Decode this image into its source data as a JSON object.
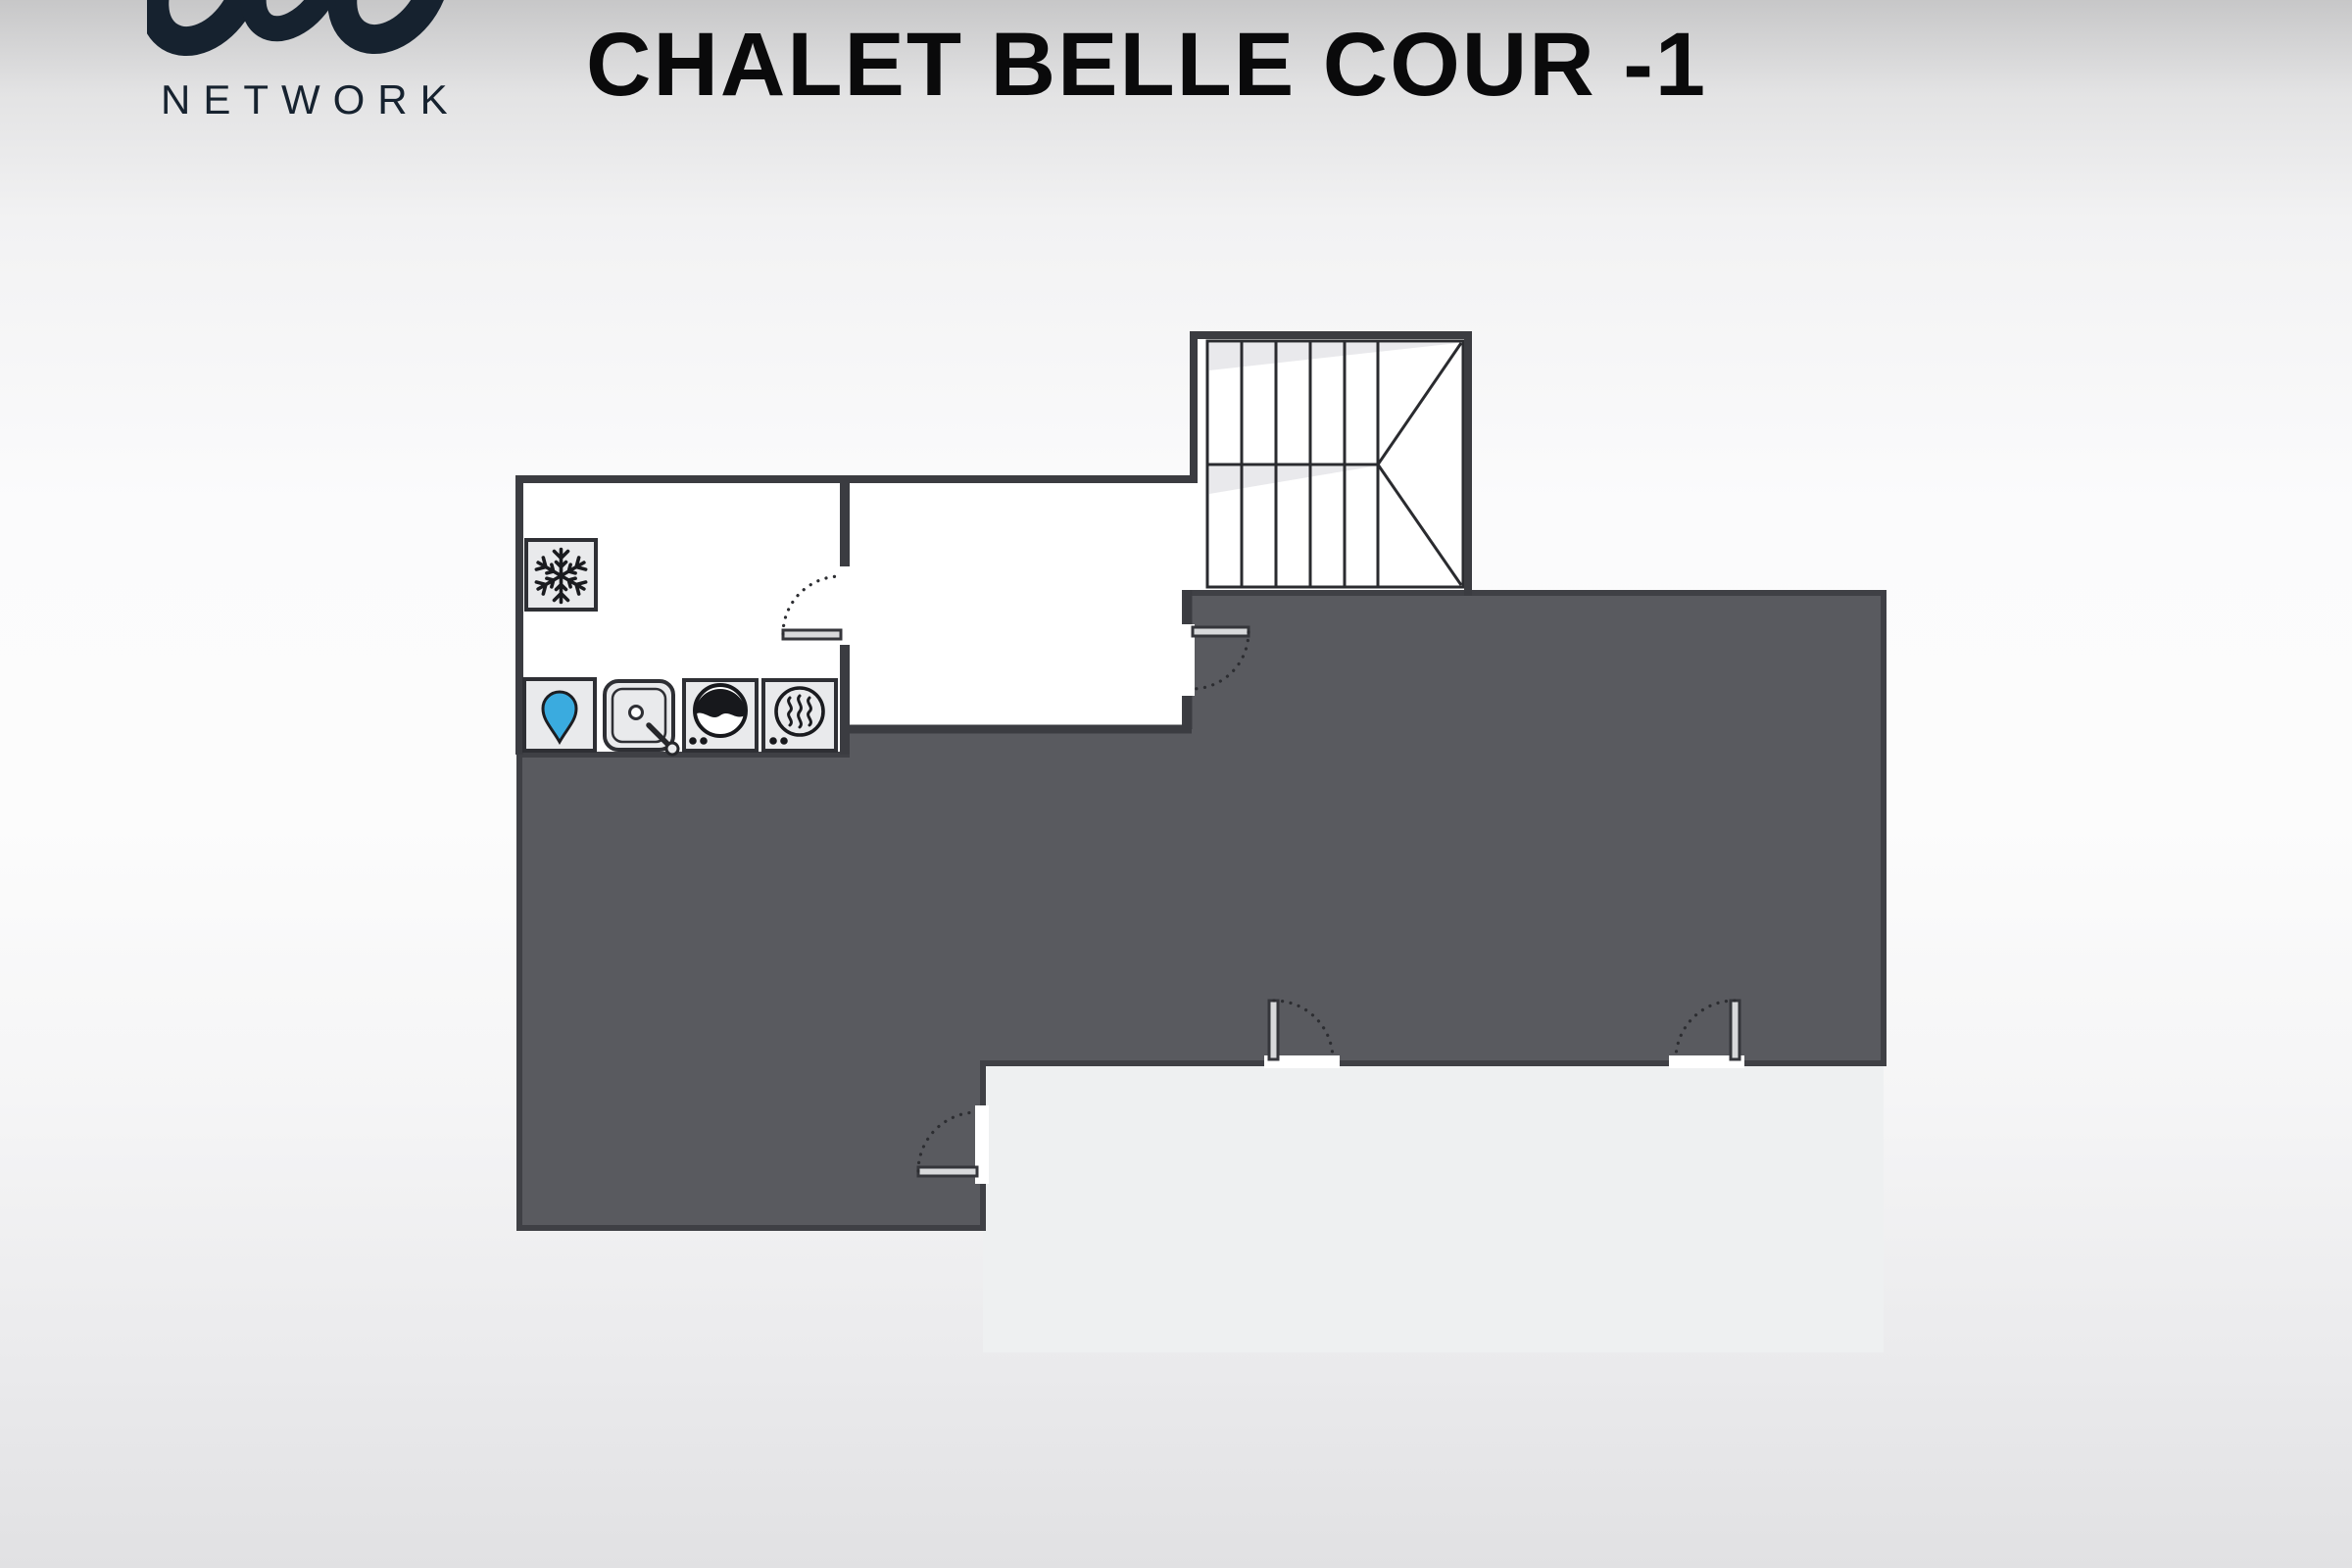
{
  "header": {
    "logo_text": "NETWORK",
    "title": "CHALET BELLE COUR -1"
  },
  "floorplan": {
    "level": "-1",
    "colors": {
      "wall": "#3b3c41",
      "dark_area_fill": "#595a5f",
      "dark_area_border": "#3f4045",
      "room_fill": "#ffffff",
      "lower_area_fill": "#eef0f1",
      "stair_shade": "#e9e9ec",
      "icon_square_fill": "#e9eaec",
      "icon_stroke": "#1a1b1f",
      "water_drop_blue": "#3aabdf",
      "door_leaf_fill": "#d8d9db",
      "logo_navy": "#16222f",
      "title_black": "#0a0a0b"
    },
    "equipment_icons": [
      "freezer-snowflake-icon",
      "water-drop-icon",
      "sink-icon",
      "washing-machine-icon",
      "tumble-dryer-icon"
    ],
    "door_count": 5,
    "staircase": {
      "flights": 2,
      "step_columns": 6
    }
  }
}
